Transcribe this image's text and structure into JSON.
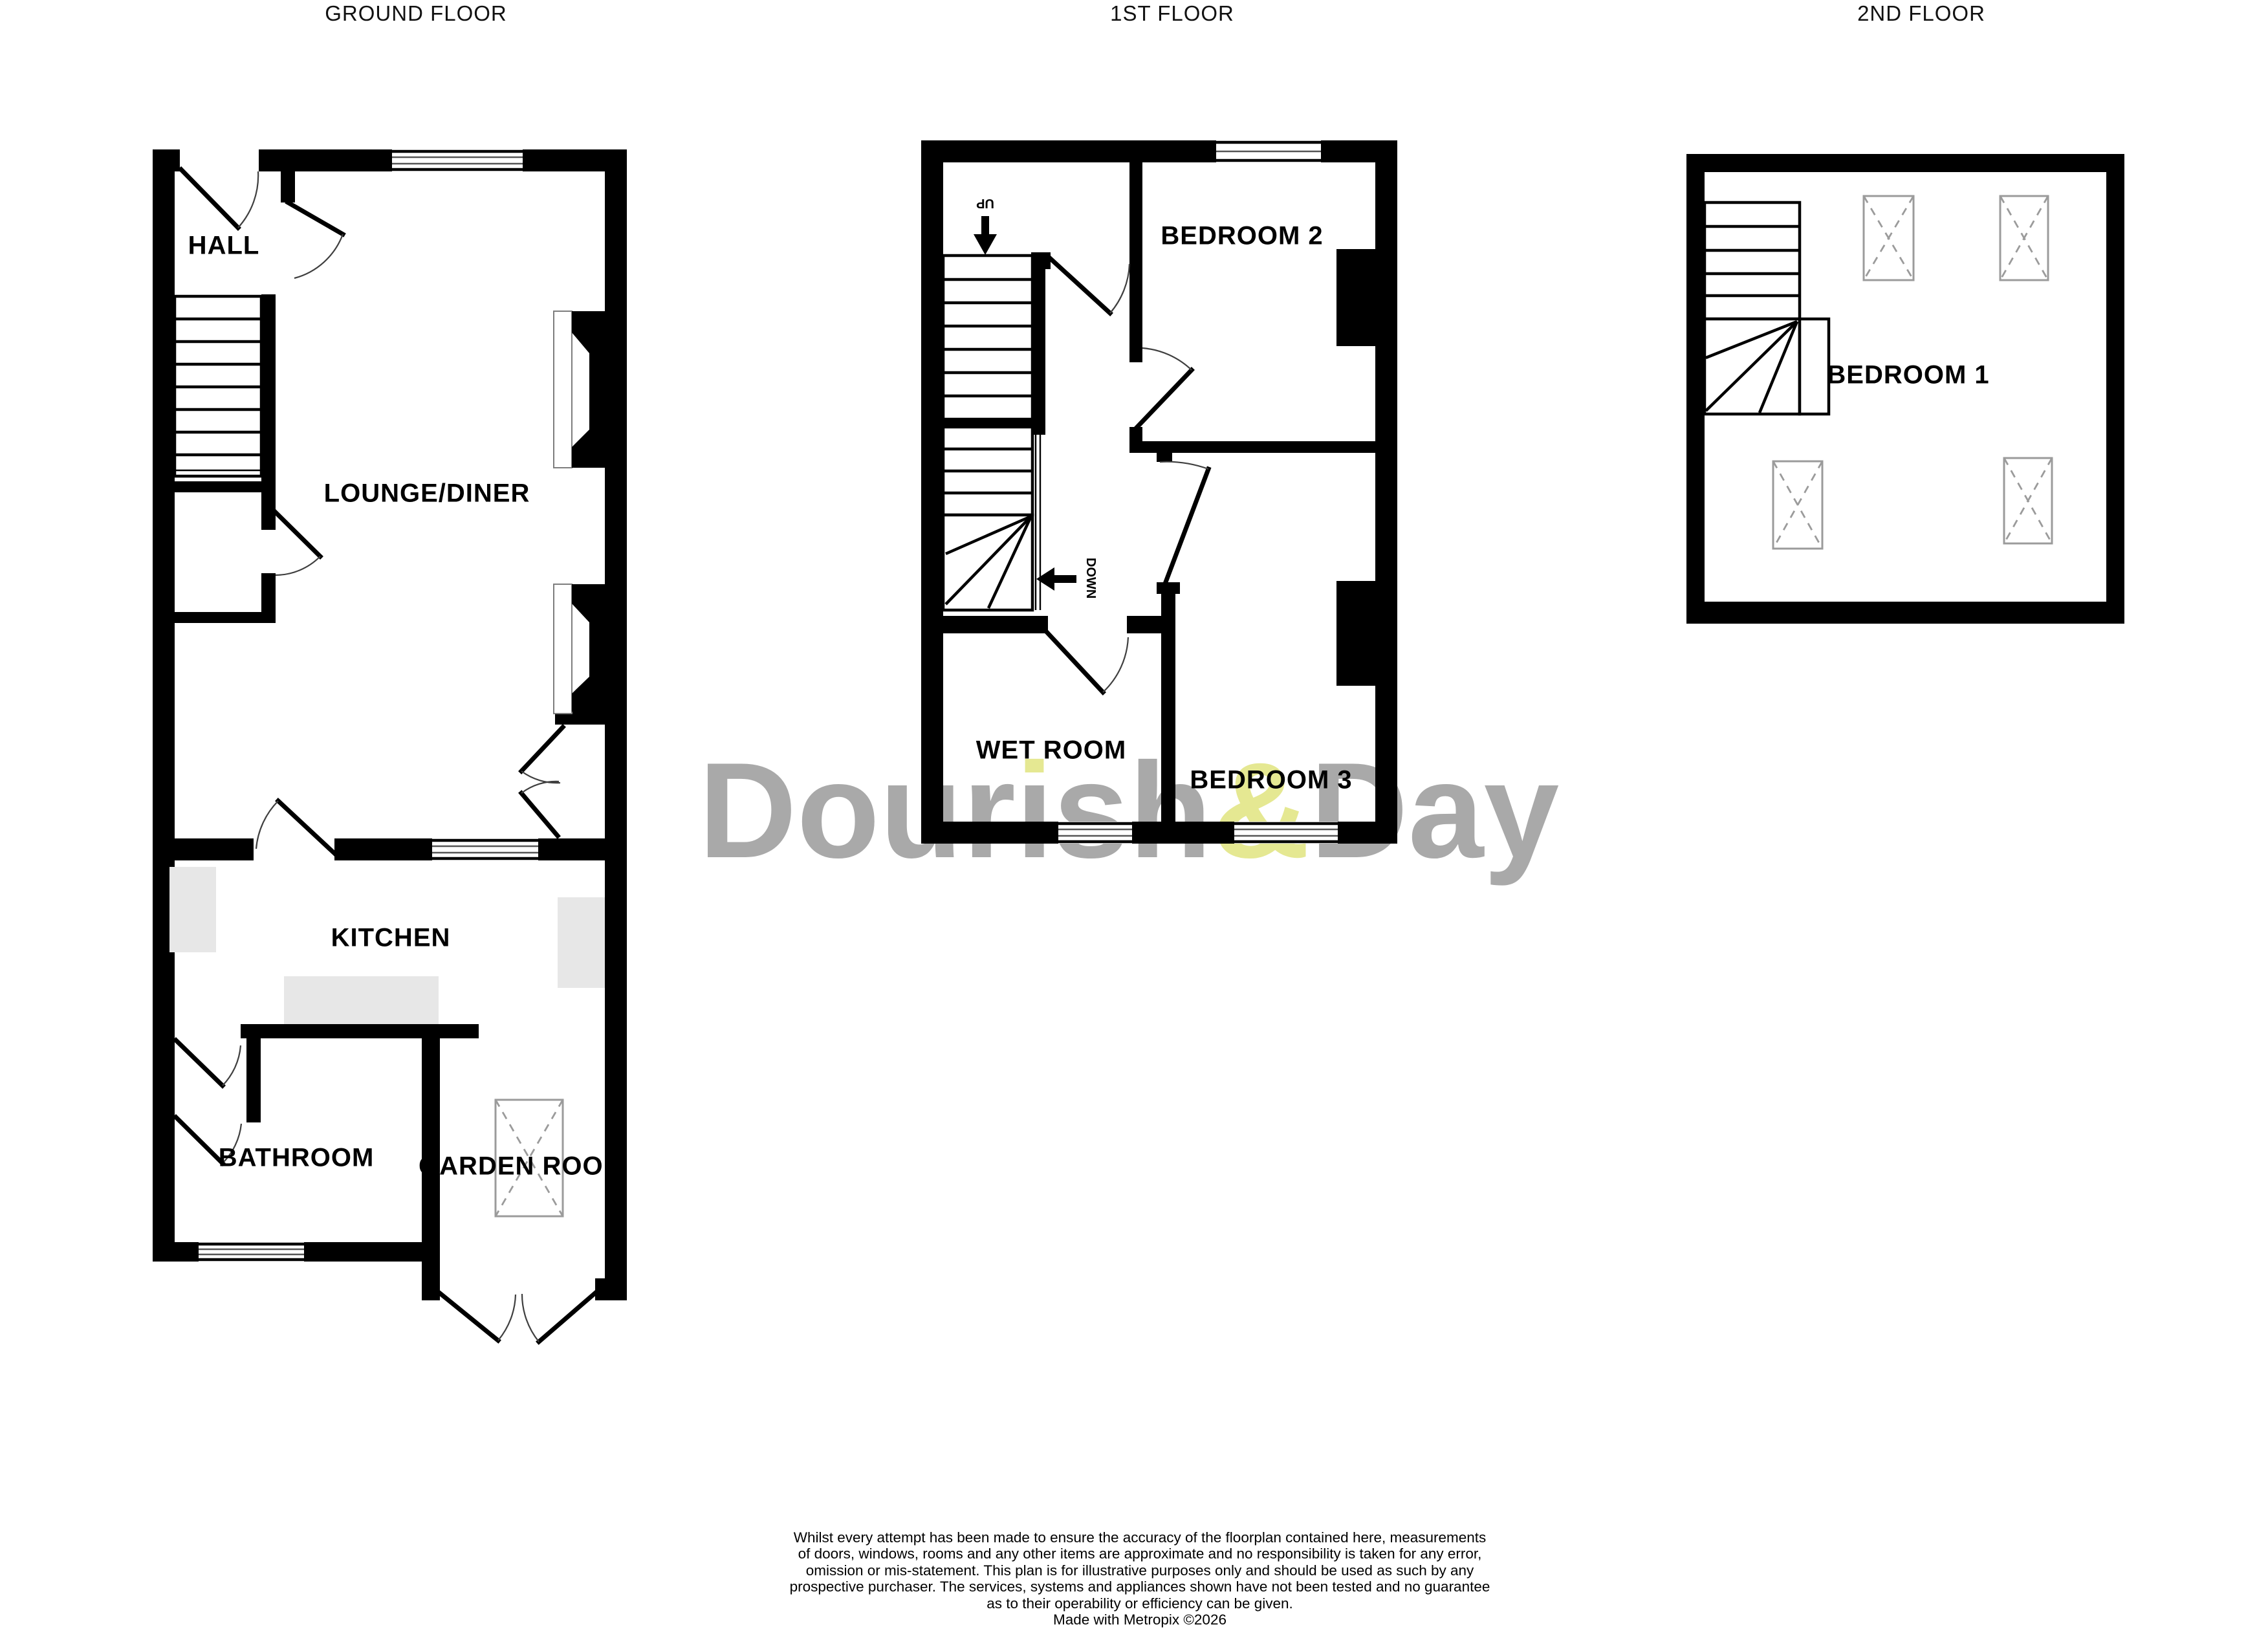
{
  "headers": {
    "ground": "GROUND FLOOR",
    "first": "1ST FLOOR",
    "second": "2ND FLOOR"
  },
  "rooms": {
    "hall": "HALL",
    "lounge": "LOUNGE/DINER",
    "kitchen": "KITCHEN",
    "bathroom": "BATHROOM",
    "garden": "GARDEN ROOM",
    "bed2": "BEDROOM 2",
    "wet": "WET ROOM",
    "bed3": "BEDROOM 3",
    "bed1": "BEDROOM 1"
  },
  "stairs": {
    "up": "UP",
    "down": "DOWN"
  },
  "watermark": {
    "full": "Dourish&Day",
    "p1": "Dour",
    "i_dotless": "ı",
    "p2": "sh",
    "amp": "&",
    "p3": "Day",
    "gray": "#a9a9a9",
    "yellow": "#e5e892"
  },
  "disclaimer": {
    "lines": [
      "Whilst every attempt has been made to ensure the accuracy of the floorplan contained here, measurements",
      "of doors, windows, rooms and any other items are approximate and no responsibility is taken for any error,",
      "omission or mis-statement. This plan is for illustrative purposes only and should be used as such by any",
      "prospective purchaser. The services, systems and appliances shown have not been tested and no guarantee",
      "as to their operability or efficiency can be given.",
      "Made with Metropix ©2026"
    ]
  },
  "colors": {
    "wall": "#000000",
    "watermark_gray": "#a9a9a9",
    "watermark_yellow": "#e5e892",
    "appliance_gray": "#e7e7e7",
    "skylight_gray": "#9b9b9b"
  }
}
